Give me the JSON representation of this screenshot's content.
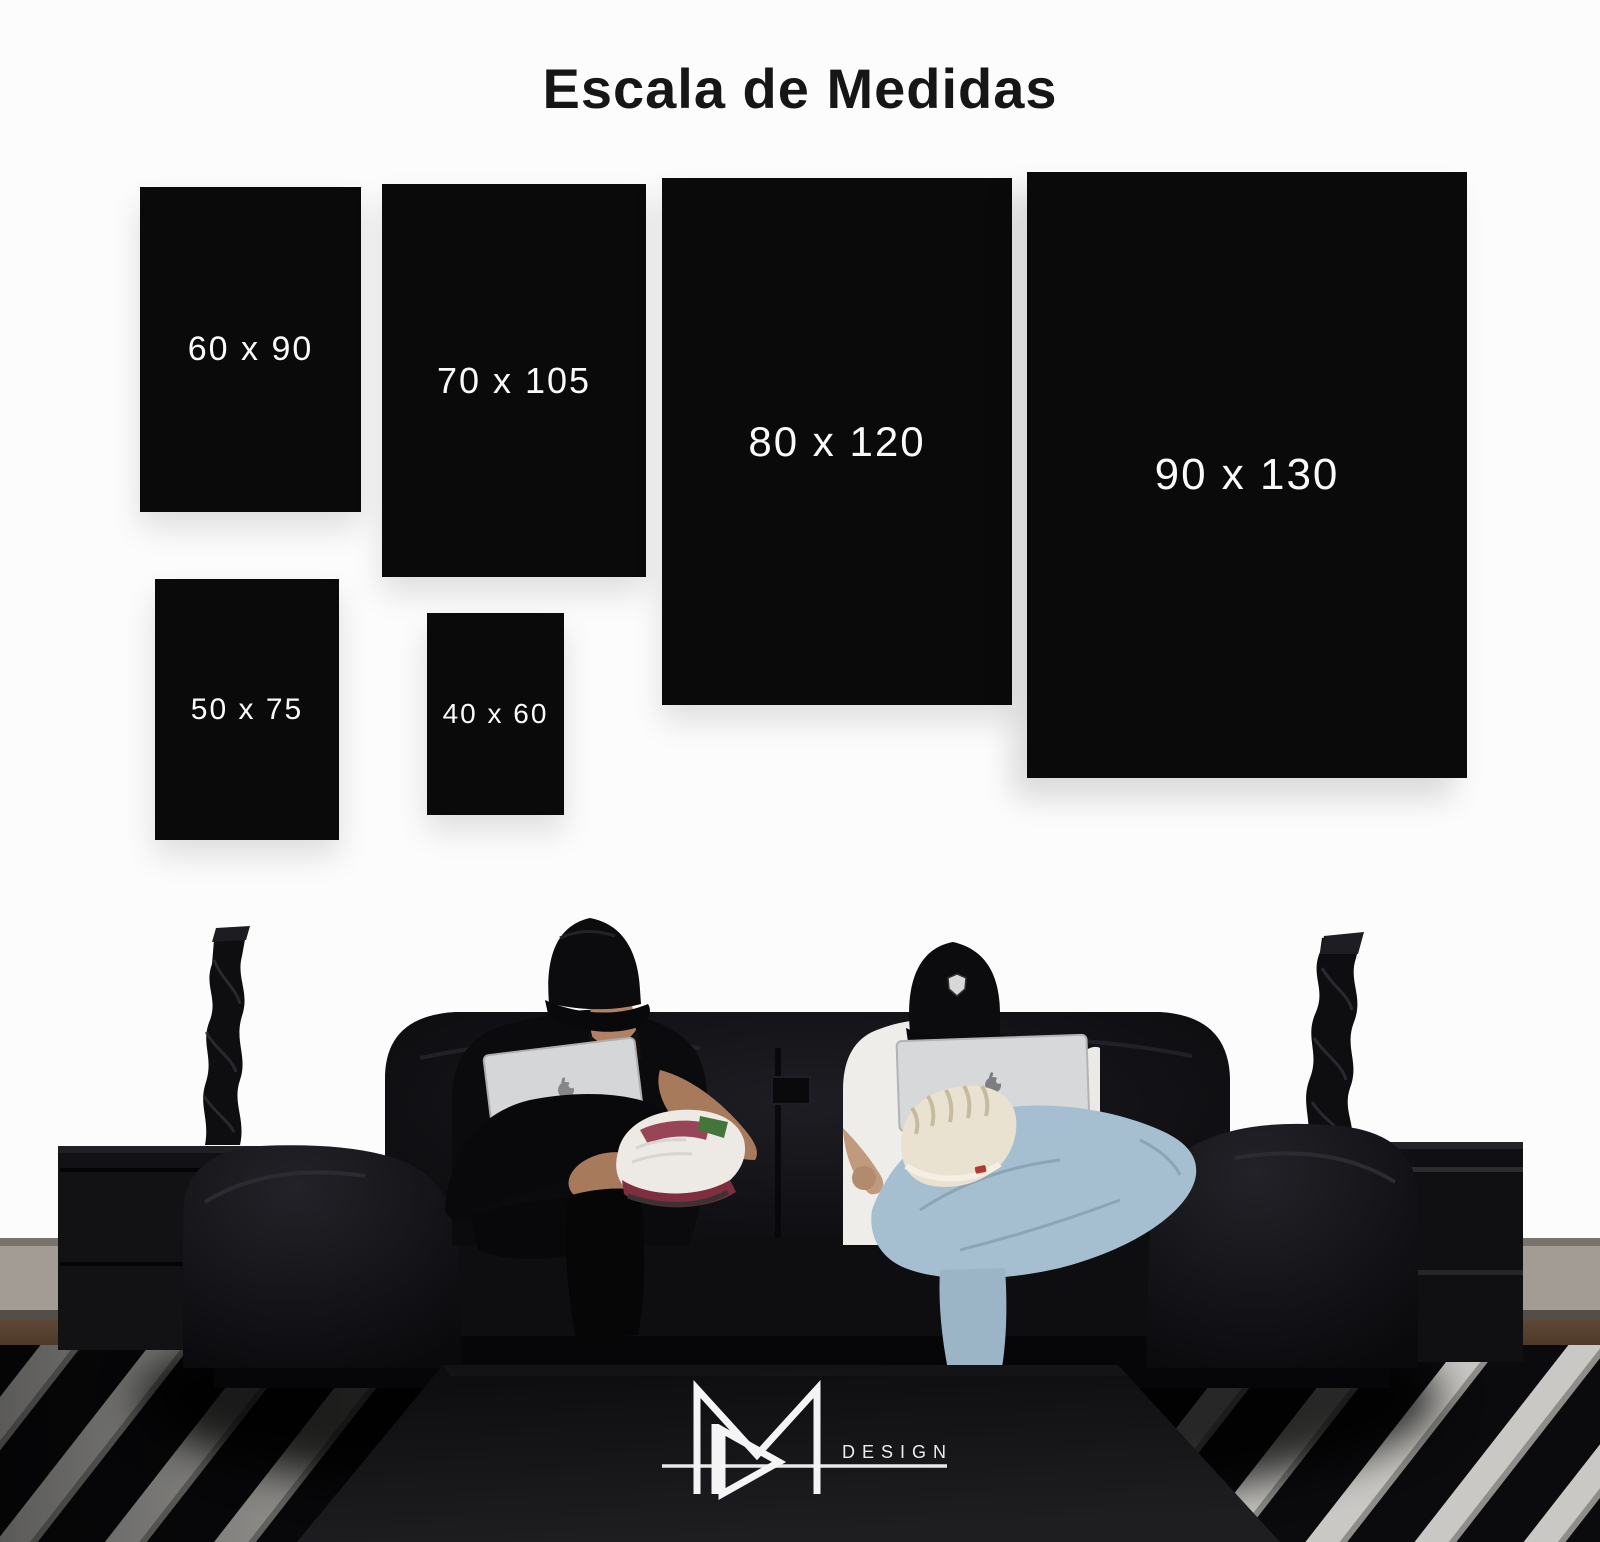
{
  "title": "Escala de Medidas",
  "sizes": [
    {
      "label": "60 x 90"
    },
    {
      "label": "70 x 105"
    },
    {
      "label": "80 x 120"
    },
    {
      "label": "90 x 130"
    },
    {
      "label": "50 x 75"
    },
    {
      "label": "40 x 60"
    }
  ],
  "brand": {
    "design_label": "DESIGN",
    "monogram": "MR"
  },
  "colors": {
    "background": "#fcfcfc",
    "panel": "#0a0a0a",
    "panel_text": "#fafafa",
    "title_text": "#161616",
    "logo": "#f2f2f2"
  }
}
